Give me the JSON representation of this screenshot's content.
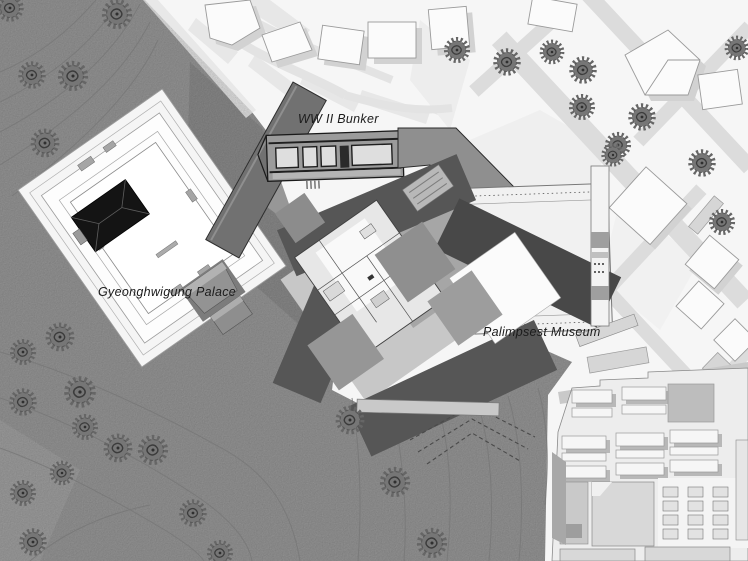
{
  "labels": {
    "palace": "Gyeonghwigung Palace",
    "bunker": "WW II Bunker",
    "museum": "Palimpsest Museum"
  },
  "colors": {
    "terrain": "#9b9b9b",
    "terrain_dark": "#8d8d8d",
    "terrain_light": "#a6a6a6",
    "contour": "#787878",
    "street": "#dcdcdc",
    "building_fill": "#fbfbfb",
    "building_stroke": "#9a9a9a",
    "building_shadow": "#d2d2d2",
    "wing_dark": "#565656",
    "wing_darker": "#484848",
    "plate_light": "#c7c7c7",
    "plate_mid": "#a6a6a6",
    "bunker_fill": "#9b9b9b",
    "ridge_fill": "#717171",
    "wall_dark": "#1f1f1f",
    "roof_black": "#141414",
    "tree": "#767676",
    "tree_detail": "#3c3c3c",
    "block_fill": "#ededed",
    "label_text": "#1b1b1b"
  },
  "trees": [
    {
      "x": 10,
      "y": 8,
      "s": 1.0
    },
    {
      "x": 117,
      "y": 14,
      "s": 1.1
    },
    {
      "x": 32,
      "y": 75,
      "s": 1.0
    },
    {
      "x": 73,
      "y": 76,
      "s": 1.1
    },
    {
      "x": 45,
      "y": 143,
      "s": 1.05
    },
    {
      "x": 60,
      "y": 337,
      "s": 1.05
    },
    {
      "x": 23,
      "y": 352,
      "s": 0.95
    },
    {
      "x": 80,
      "y": 392,
      "s": 1.15
    },
    {
      "x": 23,
      "y": 402,
      "s": 1.0
    },
    {
      "x": 85,
      "y": 427,
      "s": 0.95
    },
    {
      "x": 118,
      "y": 448,
      "s": 1.05
    },
    {
      "x": 153,
      "y": 450,
      "s": 1.1
    },
    {
      "x": 62,
      "y": 473,
      "s": 0.9
    },
    {
      "x": 23,
      "y": 493,
      "s": 0.95
    },
    {
      "x": 33,
      "y": 542,
      "s": 1.0
    },
    {
      "x": 193,
      "y": 513,
      "s": 1.0
    },
    {
      "x": 220,
      "y": 553,
      "s": 0.95
    },
    {
      "x": 350,
      "y": 420,
      "s": 1.05
    },
    {
      "x": 395,
      "y": 482,
      "s": 1.1
    },
    {
      "x": 432,
      "y": 543,
      "s": 1.1
    },
    {
      "x": 457,
      "y": 50,
      "s": 0.95
    },
    {
      "x": 507,
      "y": 62,
      "s": 1.0
    },
    {
      "x": 552,
      "y": 52,
      "s": 0.9
    },
    {
      "x": 583,
      "y": 70,
      "s": 1.0
    },
    {
      "x": 582,
      "y": 107,
      "s": 0.95
    },
    {
      "x": 642,
      "y": 117,
      "s": 1.0
    },
    {
      "x": 618,
      "y": 145,
      "s": 0.95
    },
    {
      "x": 702,
      "y": 163,
      "s": 1.0
    },
    {
      "x": 737,
      "y": 48,
      "s": 0.9
    },
    {
      "x": 613,
      "y": 155,
      "s": 0.85
    },
    {
      "x": 722,
      "y": 222,
      "s": 0.95
    }
  ]
}
